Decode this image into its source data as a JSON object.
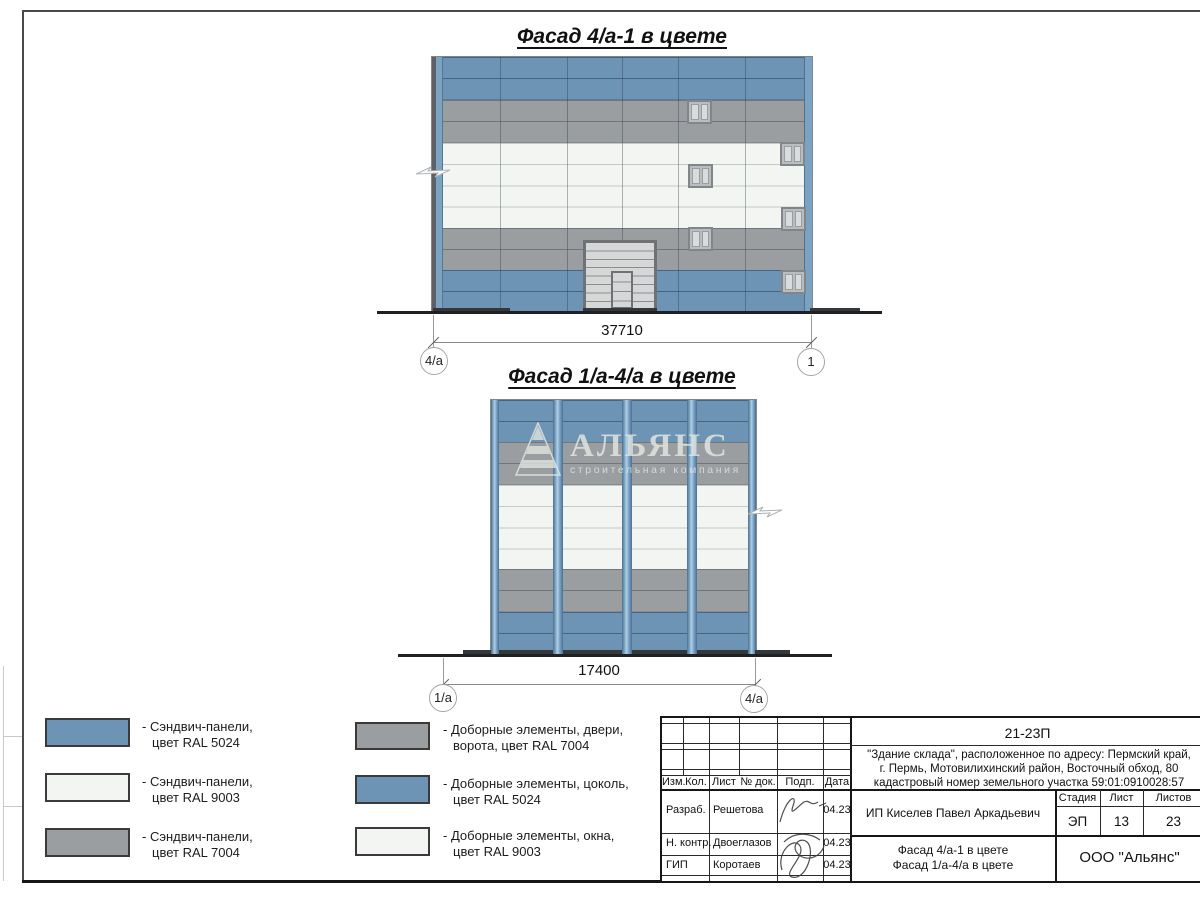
{
  "colors": {
    "panel_blue": "#6d94b5",
    "panel_gray": "#9b9ea0",
    "panel_white": "#f2f5f1",
    "pilaster_light": "#b3cfe4",
    "ground": "#1e2022"
  },
  "facade1": {
    "title": "Фасад 4/а-1 в цвете",
    "dimension": "37710",
    "axis_left": "4/а",
    "axis_right": "1"
  },
  "facade2": {
    "title": "Фасад 1/а-4/а в цвете",
    "dimension": "17400",
    "axis_left": "1/а",
    "axis_right": "4/а"
  },
  "watermark": {
    "name": "АЛЬЯНС",
    "tagline": "строительная компания"
  },
  "legend": {
    "items": [
      {
        "color": "#6d94b5",
        "line1": "- Сэндвич-панели,",
        "line2": "цвет RAL 5024"
      },
      {
        "color": "#f2f5f1",
        "line1": "- Сэндвич-панели,",
        "line2": "цвет RAL 9003"
      },
      {
        "color": "#9b9ea0",
        "line1": "- Сэндвич-панели,",
        "line2": "цвет RAL 7004"
      },
      {
        "color": "#9b9ea0",
        "line1": "- Доборные элементы, двери,",
        "line2": "ворота, цвет RAL 7004"
      },
      {
        "color": "#6d94b5",
        "line1": "- Доборные элементы, цоколь,",
        "line2": "цвет RAL 5024"
      },
      {
        "color": "#f2f5f1",
        "line1": "- Доборные элементы, окна,",
        "line2": "цвет RAL 9003"
      }
    ]
  },
  "title_block": {
    "code": "21-23П",
    "address_line1": "\"Здание склада\", расположенное по адресу: Пермский край,",
    "address_line2": "г. Пермь, Мотовилихинский район, Восточный обход, 80",
    "address_line3": "кадастровый номер земельного участка 59:01:0910028:57",
    "header": [
      "Изм.",
      "Кол.",
      "Лист",
      "№ док.",
      "Подп.",
      "Дата"
    ],
    "rows": [
      {
        "role": "Разраб.",
        "name": "Решетова",
        "date": "04.23"
      },
      {
        "role": "Н. контр.",
        "name": "Двоеглазов",
        "date": "04.23"
      },
      {
        "role": "ГИП",
        "name": "Коротаев",
        "date": "04.23"
      }
    ],
    "client": "ИП Киселев Павел Аркадьевич",
    "stage_label": "Стадия",
    "sheet_label": "Лист",
    "sheets_label": "Листов",
    "stage": "ЭП",
    "sheet": "13",
    "sheets": "23",
    "doc_line1": "Фасад 4/а-1 в цвете",
    "doc_line2": "Фасад 1/а-4/а в цвете",
    "company": "ООО \"Альянс\""
  }
}
